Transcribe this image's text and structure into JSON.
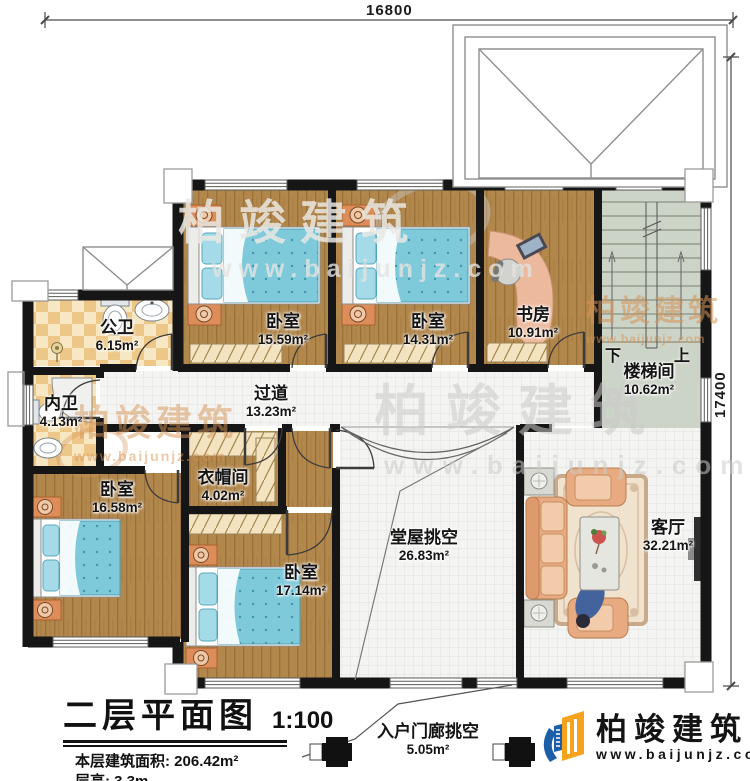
{
  "dims": {
    "top": "16800",
    "right": "17400"
  },
  "rooms": {
    "bedroom1": {
      "name": "卧室",
      "area": "15.59m²"
    },
    "bedroom2": {
      "name": "卧室",
      "area": "14.31m²"
    },
    "study": {
      "name": "书房",
      "area": "10.91m²"
    },
    "stairwell": {
      "name": "楼梯间",
      "area": "10.62m²"
    },
    "public_bath": {
      "name": "公卫",
      "area": "6.15m²"
    },
    "private_bath": {
      "name": "内卫",
      "area": "4.13m²"
    },
    "corridor": {
      "name": "过道",
      "area": "13.23m²"
    },
    "cloakroom": {
      "name": "衣帽间",
      "area": "4.02m²"
    },
    "bedroom3": {
      "name": "卧室",
      "area": "16.58m²"
    },
    "bedroom4": {
      "name": "卧室",
      "area": "17.14m²"
    },
    "hall_void": {
      "name": "堂屋挑空",
      "area": "26.83m²"
    },
    "living": {
      "name": "客厅",
      "area": "32.21m²"
    },
    "porch_void": {
      "name": "入户门廊挑空",
      "area": "5.05m²"
    }
  },
  "stairs": {
    "down": "下",
    "up": "上"
  },
  "titleblock": {
    "main": "二层平面图",
    "scale": "1:100",
    "area_label": "本层建筑面积:",
    "area_value": "206.42m²",
    "height_label": "层高:",
    "height_value": "3.3m"
  },
  "logo": {
    "name": "柏竣建筑",
    "site": "www.baijunjz.com"
  },
  "watermark": {
    "name": "柏竣建筑",
    "site": "www.baijunjz.com"
  },
  "colors": {
    "wall": "#161616",
    "wood": "#b2874b",
    "tile_light": "#f7e7c3",
    "tile_dark": "#edc787",
    "bed": "#7ecadb",
    "floor_tile": "#f4f4f2",
    "stair_floor": "#ccd3c7",
    "sofa": "#e8aa80",
    "logo_blue": "#1c5fa8",
    "logo_orange": "#f6a21c"
  }
}
